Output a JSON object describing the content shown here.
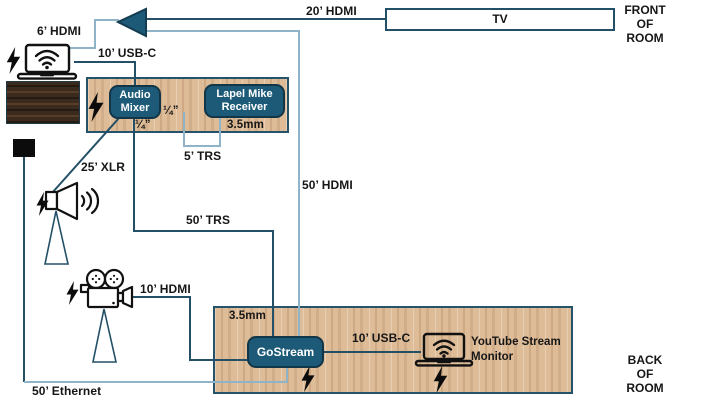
{
  "diagram": {
    "room_position_labels": {
      "front": [
        "FRONT",
        "OF",
        "ROOM"
      ],
      "back": [
        "BACK",
        "OF",
        "ROOM"
      ]
    },
    "devices": {
      "tv": "TV",
      "audio_mixer": [
        "Audio",
        "Mixer"
      ],
      "lapel_mike_receiver": [
        "Lapel Mike",
        "Receiver"
      ],
      "gostream": "GoStream",
      "youtube_stream_monitor": [
        "YouTube Stream",
        "Monitor"
      ]
    },
    "cables": {
      "hdmi_20ft": "20’ HDMI",
      "hdmi_6ft": "6’ HDMI",
      "usb_c_10ft_mixer": "10’ USB-C",
      "hdmi_50ft": "50’ HDMI",
      "xlr_25ft": "25’ XLR",
      "trs_5ft": "5’ TRS",
      "trs_50ft": "50’ TRS",
      "hdmi_10ft": "10’ HDMI",
      "ethernet_50ft": "50’ Ethernet",
      "usb_c_10ft_monitor": "10’ USB-C"
    },
    "ports": {
      "quarter_inch_right": "¼”",
      "quarter_inch_below": "¼”",
      "mm_3_5_receiver": "3.5mm",
      "mm_3_5_gostream": "3.5mm"
    },
    "icons": {
      "projector-icon": "teal left-pointing triangle projector",
      "laptop-icon": "laptop with wifi symbol",
      "power-bolt-icon": "black lightning bolt (power)",
      "speaker-icon": "horn speaker with sound waves",
      "tripod-icon": "tripod stand triangle",
      "video-camera-icon": "film camera with two reels",
      "network-jack": "black wall network jack"
    },
    "colors": {
      "cable_dark": "#235067",
      "cable_light": "#8fb4c7",
      "device_fill": "#1d5a78",
      "device_border": "#123648",
      "wood_light": "#debc97",
      "wood_dark": "#3b2b1e"
    }
  }
}
